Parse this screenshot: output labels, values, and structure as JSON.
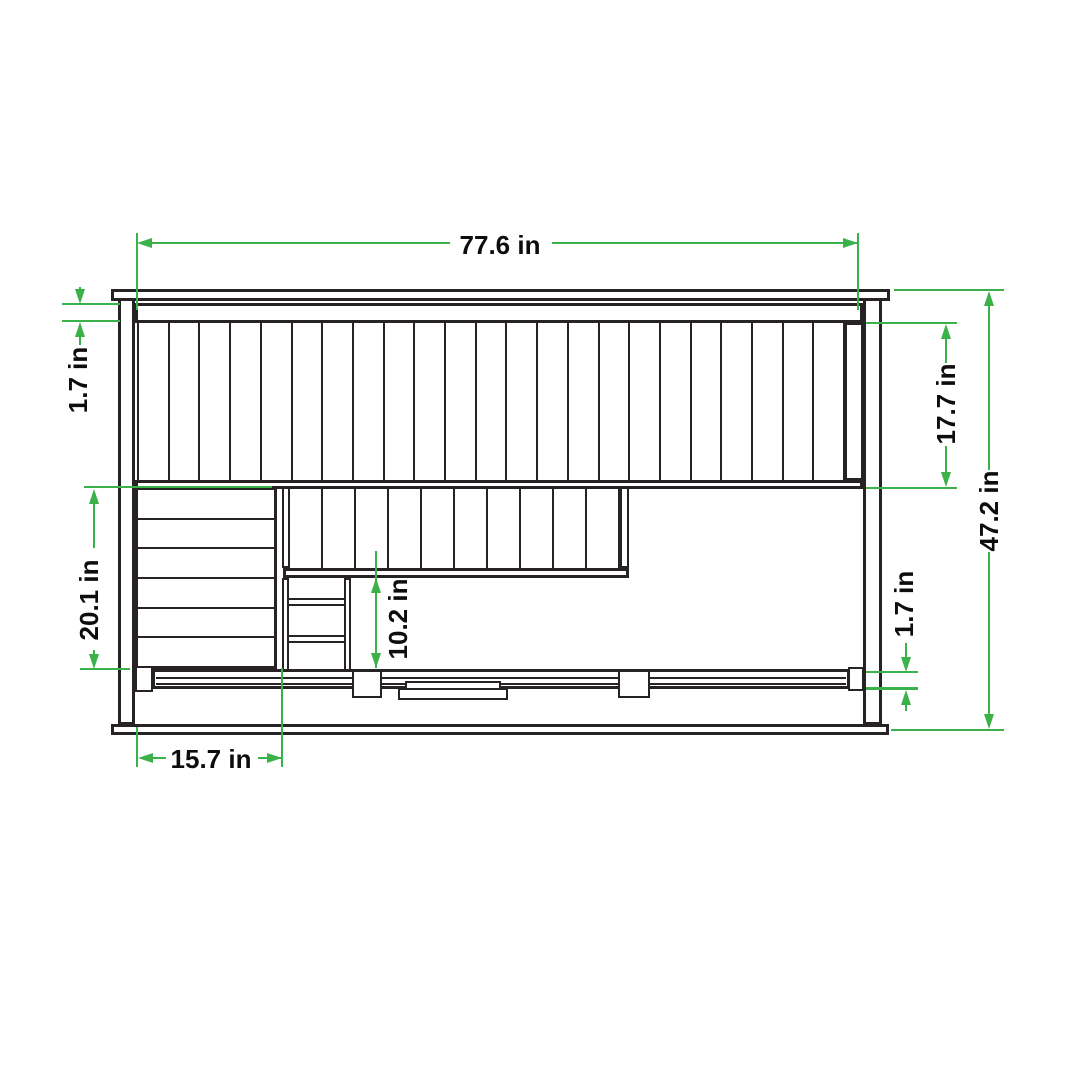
{
  "drawing": {
    "unit": "in",
    "palette": {
      "dimension_green": "#3bb14a",
      "line_ink": "#272324",
      "background": "#ffffff"
    },
    "dimensions": {
      "overall_width": {
        "value": 77.6,
        "label": "77.6 in",
        "orientation": "horizontal"
      },
      "top_rail_thickness": {
        "value": 1.7,
        "label": "1.7 in",
        "orientation": "vertical"
      },
      "upper_panel_height": {
        "value": 17.7,
        "label": "17.7 in",
        "orientation": "vertical"
      },
      "overall_height": {
        "value": 47.2,
        "label": "47.2 in",
        "orientation": "vertical"
      },
      "left_panel_height": {
        "value": 20.1,
        "label": "20.1 in",
        "orientation": "vertical"
      },
      "rail_clearance": {
        "value": 10.2,
        "label": "10.2 in",
        "orientation": "vertical"
      },
      "bottom_rail_thickness": {
        "value": 1.7,
        "label": "1.7 in",
        "orientation": "vertical"
      },
      "ladder_section_width": {
        "value": 15.7,
        "label": "15.7 in",
        "orientation": "horizontal"
      }
    },
    "structure": {
      "upper_slat_count": 23,
      "lower_slat_count": 10,
      "side_panel_boards": 6,
      "ladder_rungs": 2
    }
  }
}
